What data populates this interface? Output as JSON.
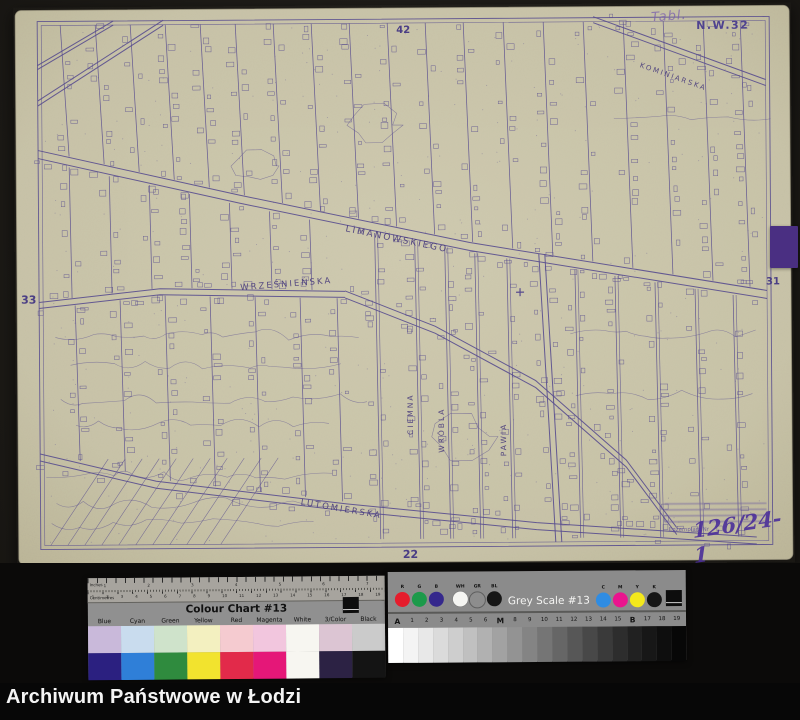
{
  "archive": {
    "caption": "Archiwum Państwowe w Łodzi"
  },
  "map": {
    "sheet_code": "N.W.32",
    "handwritten_note": "Tabl.",
    "edge_numbers": {
      "top": "42",
      "left": "33",
      "right": "31",
      "bottom": "22"
    },
    "streets": [
      {
        "name": "LIMANOWSKIEGO",
        "left": 332,
        "top": 219,
        "angle": 12,
        "vertical": false,
        "size": 9
      },
      {
        "name": "WRZEŚNIEŃSKA",
        "left": 225,
        "top": 277,
        "angle": -4,
        "vertical": false,
        "size": 8.5
      },
      {
        "name": "LUTOMIERSKA",
        "left": 285,
        "top": 492,
        "angle": 10,
        "vertical": false,
        "size": 8.5
      },
      {
        "name": "KOMINIARSKA",
        "left": 628,
        "top": 58,
        "angle": 20,
        "vertical": false,
        "size": 7
      },
      {
        "name": "CIEMNA",
        "left": 390,
        "top": 430,
        "angle": -90,
        "vertical": true,
        "size": 7.5
      },
      {
        "name": "WRÓBLA",
        "left": 421,
        "top": 448,
        "angle": -90,
        "vertical": true,
        "size": 7.5
      },
      {
        "name": "PAWIA",
        "left": 483,
        "top": 452,
        "angle": -90,
        "vertical": true,
        "size": 7.5
      }
    ],
    "stamp": {
      "label": "Egzemplarz Nr",
      "number": "126/24-1"
    },
    "ink_color": "#584c8f",
    "paper_color": "#c9c4a9"
  },
  "colour_chart": {
    "title": "Colour Chart #13",
    "ruler_top_label": "Inches",
    "ruler_bottom_label": "Centimetres",
    "inch_numbers": [
      "1",
      "2",
      "3",
      "4",
      "5",
      "6",
      "7"
    ],
    "cm_numbers": [
      "1",
      "2",
      "3",
      "4",
      "5",
      "6",
      "7",
      "8",
      "9",
      "10",
      "11",
      "12",
      "13",
      "14",
      "15",
      "16",
      "17",
      "18",
      "19"
    ],
    "columns": [
      {
        "label": "Blue",
        "light": "#c9b9da",
        "dark": "#2b2080"
      },
      {
        "label": "Cyan",
        "light": "#c9dcee",
        "dark": "#2f7fd8"
      },
      {
        "label": "Green",
        "light": "#cfe3cb",
        "dark": "#2f8b3e"
      },
      {
        "label": "Yellow",
        "light": "#f3f0c0",
        "dark": "#f2e32e"
      },
      {
        "label": "Red",
        "light": "#f5cbd0",
        "dark": "#e22a4a"
      },
      {
        "label": "Magenta",
        "light": "#f2c6de",
        "dark": "#e51778"
      },
      {
        "label": "White",
        "light": "#f7f6f1",
        "dark": "#f7f6f1"
      },
      {
        "label": "3/Color",
        "light": "#dcc5d3",
        "dark": "#2c2244"
      },
      {
        "label": "Black",
        "light": "#cbcbcb",
        "dark": "#141414"
      }
    ]
  },
  "grey_scale": {
    "title": "Grey Scale #13",
    "dots_left": [
      {
        "label": "R",
        "color": "#e51c2c"
      },
      {
        "label": "G",
        "color": "#1c9a4a"
      },
      {
        "label": "B",
        "color": "#35288c"
      },
      {
        "label": "WH",
        "color": "#f5f5f2"
      },
      {
        "label": "GR",
        "color": "#8d8d8d"
      },
      {
        "label": "BL",
        "color": "#161616"
      }
    ],
    "dots_right": [
      {
        "label": "C",
        "color": "#2f8ce2"
      },
      {
        "label": "M",
        "color": "#ea148e"
      },
      {
        "label": "Y",
        "color": "#f4e81c"
      },
      {
        "label": "K",
        "color": "#161616"
      }
    ],
    "scale_labels": [
      "A",
      "1",
      "2",
      "3",
      "4",
      "5",
      "6",
      "M",
      "8",
      "9",
      "10",
      "11",
      "12",
      "13",
      "14",
      "15",
      "B",
      "17",
      "18",
      "19"
    ],
    "patches": [
      "#ffffff",
      "#f4f4f4",
      "#e8e8e8",
      "#dbdbdb",
      "#cecece",
      "#c0c0c0",
      "#b1b1b1",
      "#a2a2a2",
      "#939393",
      "#848484",
      "#757575",
      "#666666",
      "#575757",
      "#484848",
      "#3a3a3a",
      "#2d2d2d",
      "#212121",
      "#171717",
      "#0e0e0e",
      "#070707"
    ]
  }
}
